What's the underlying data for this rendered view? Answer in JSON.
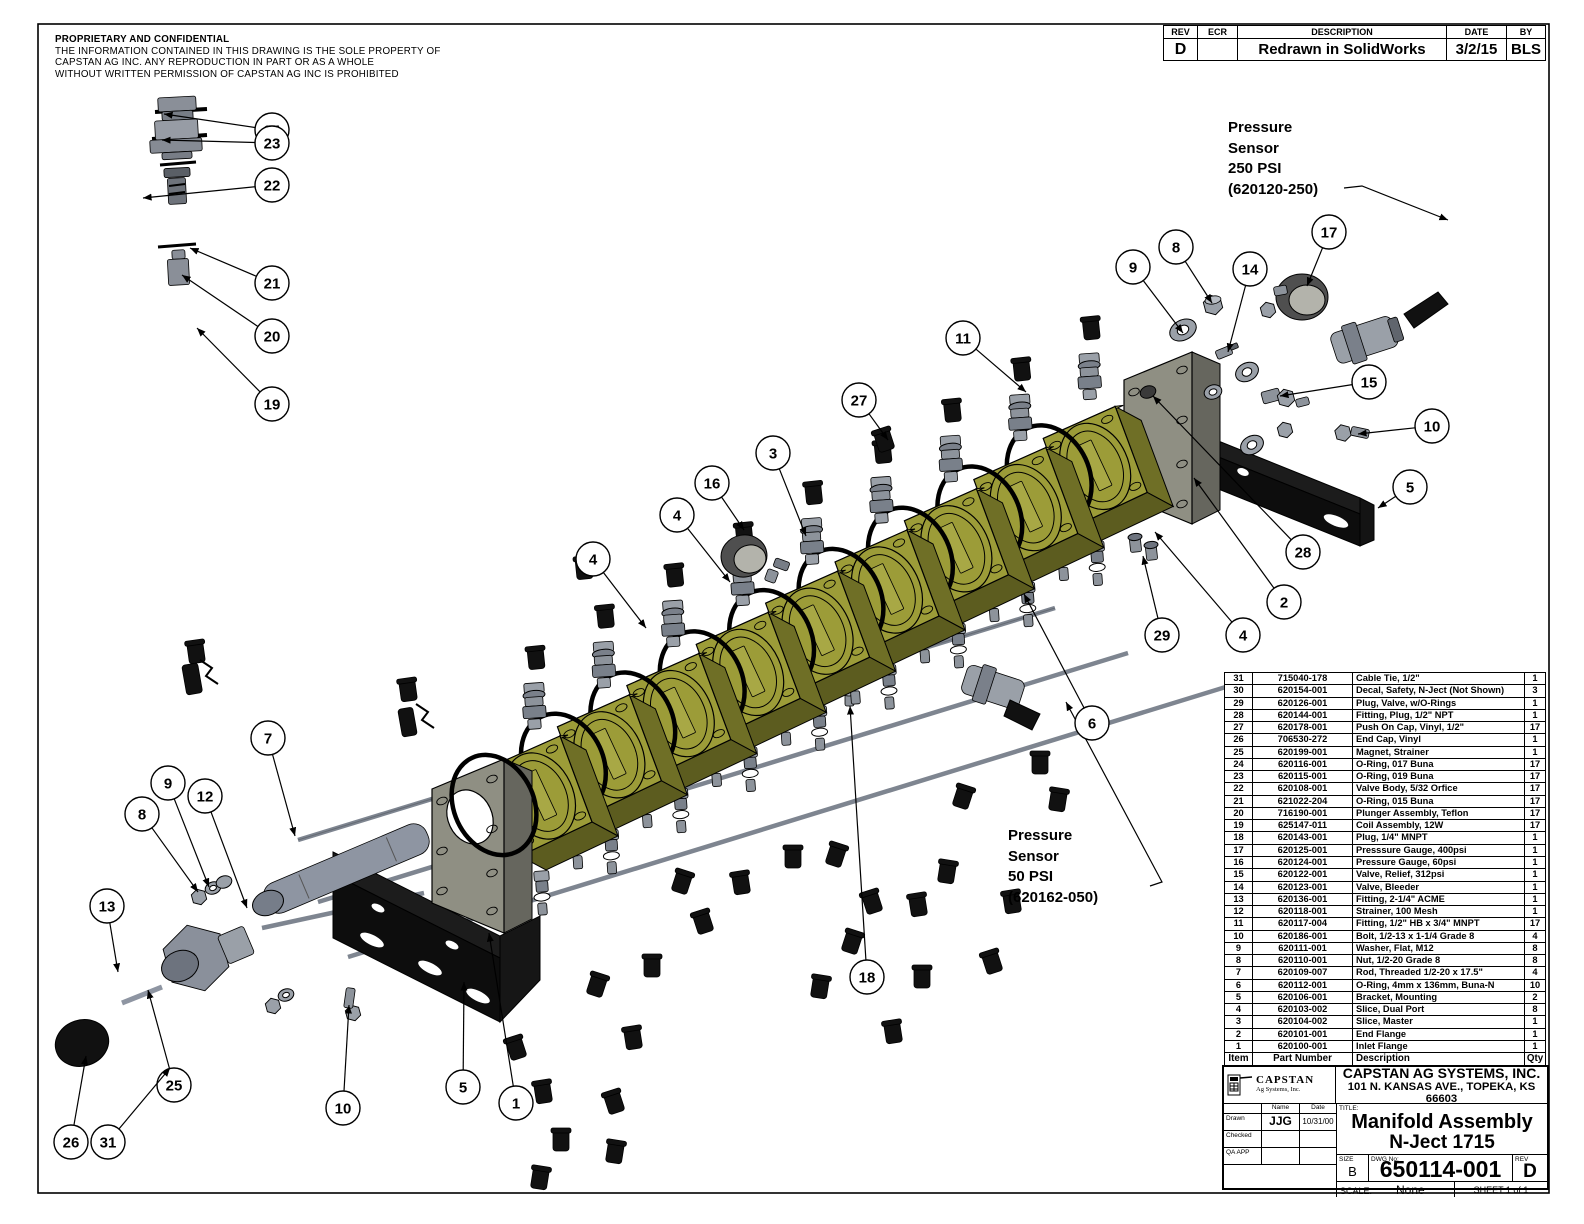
{
  "notice": {
    "title": "PROPRIETARY AND CONFIDENTIAL",
    "lines": [
      "THE INFORMATION CONTAINED IN THIS DRAWING IS THE SOLE PROPERTY OF",
      "CAPSTAN AG INC. ANY REPRODUCTION IN PART OR AS A WHOLE",
      "WITHOUT WRITTEN PERMISSION OF CAPSTAN AG INC IS PROHIBITED"
    ]
  },
  "revision_table": {
    "headers": [
      "REV",
      "ECR",
      "DESCRIPTION",
      "DATE",
      "BY"
    ],
    "row": {
      "rev": "D",
      "ecr": "",
      "description": "Redrawn in SolidWorks",
      "date": "3/2/15",
      "by": "BLS"
    }
  },
  "labels": {
    "sensor250": [
      "Pressure",
      "Sensor",
      "250 PSI",
      "(620120-250)"
    ],
    "sensor50": [
      "Pressure",
      "Sensor",
      "50 PSI",
      "(620162-050)"
    ]
  },
  "parts_table": {
    "headers": [
      "Item",
      "Part Number",
      "Description",
      "Qty"
    ],
    "rows": [
      {
        "item": 31,
        "pn": "715040-178",
        "desc": "Cable Tie, 1/2\"",
        "qty": 1
      },
      {
        "item": 30,
        "pn": "620154-001",
        "desc": "Decal, Safety, N-Ject (Not Shown)",
        "qty": 3
      },
      {
        "item": 29,
        "pn": "620126-001",
        "desc": "Plug, Valve, w/O-Rings",
        "qty": 1
      },
      {
        "item": 28,
        "pn": "620144-001",
        "desc": "Fitting, Plug, 1/2\" NPT",
        "qty": 1
      },
      {
        "item": 27,
        "pn": "620178-001",
        "desc": "Push On Cap, Vinyl, 1/2\"",
        "qty": 17
      },
      {
        "item": 26,
        "pn": "706530-272",
        "desc": "End Cap, Vinyl",
        "qty": 1
      },
      {
        "item": 25,
        "pn": "620199-001",
        "desc": "Magnet, Strainer",
        "qty": 1
      },
      {
        "item": 24,
        "pn": "620116-001",
        "desc": "O-Ring, 017 Buna",
        "qty": 17
      },
      {
        "item": 23,
        "pn": "620115-001",
        "desc": "O-Ring, 019 Buna",
        "qty": 17
      },
      {
        "item": 22,
        "pn": "620108-001",
        "desc": "Valve Body, 5/32 Orfice",
        "qty": 17
      },
      {
        "item": 21,
        "pn": "621022-204",
        "desc": "O-Ring, 015 Buna",
        "qty": 17
      },
      {
        "item": 20,
        "pn": "716190-001",
        "desc": "Plunger Assembly, Teflon",
        "qty": 17
      },
      {
        "item": 19,
        "pn": "625147-011",
        "desc": "Coil Assembly, 12W",
        "qty": 17
      },
      {
        "item": 18,
        "pn": "620143-001",
        "desc": "Plug, 1/4\" MNPT",
        "qty": 1
      },
      {
        "item": 17,
        "pn": "620125-001",
        "desc": "Presssure Gauge, 400psi",
        "qty": 1
      },
      {
        "item": 16,
        "pn": "620124-001",
        "desc": "Pressure Gauge, 60psi",
        "qty": 1
      },
      {
        "item": 15,
        "pn": "620122-001",
        "desc": "Valve, Relief, 312psi",
        "qty": 1
      },
      {
        "item": 14,
        "pn": "620123-001",
        "desc": "Valve, Bleeder",
        "qty": 1
      },
      {
        "item": 13,
        "pn": "620136-001",
        "desc": "Fitting, 2-1/4\" ACME",
        "qty": 1
      },
      {
        "item": 12,
        "pn": "620118-001",
        "desc": "Strainer, 100 Mesh",
        "qty": 1
      },
      {
        "item": 11,
        "pn": "620117-004",
        "desc": "Fitting, 1/2\" HB x 3/4\" MNPT",
        "qty": 17
      },
      {
        "item": 10,
        "pn": "620186-001",
        "desc": "Bolt, 1/2-13 x 1-1/4 Grade 8",
        "qty": 4
      },
      {
        "item": 9,
        "pn": "620111-001",
        "desc": "Washer, Flat, M12",
        "qty": 8
      },
      {
        "item": 8,
        "pn": "620110-001",
        "desc": "Nut, 1/2-20 Grade 8",
        "qty": 8
      },
      {
        "item": 7,
        "pn": "620109-007",
        "desc": "Rod, Threaded 1/2-20 x 17.5\"",
        "qty": 4
      },
      {
        "item": 6,
        "pn": "620112-001",
        "desc": "O-Ring, 4mm x 136mm, Buna-N",
        "qty": 10
      },
      {
        "item": 5,
        "pn": "620106-001",
        "desc": "Bracket, Mounting",
        "qty": 2
      },
      {
        "item": 4,
        "pn": "620103-002",
        "desc": "Slice, Dual Port",
        "qty": 8
      },
      {
        "item": 3,
        "pn": "620104-002",
        "desc": "Slice, Master",
        "qty": 1
      },
      {
        "item": 2,
        "pn": "620101-001",
        "desc": "End Flange",
        "qty": 1
      },
      {
        "item": 1,
        "pn": "620100-001",
        "desc": "Inlet Flange",
        "qty": 1
      }
    ]
  },
  "title_block": {
    "logo_line1": "CAPSTAN",
    "logo_line2": "Ag Systems, Inc.",
    "company": "CAPSTAN AG SYSTEMS, INC.",
    "address": "101 N. KANSAS AVE., TOPEKA, KS 66603",
    "name_header": "Name",
    "date_header": "Date",
    "drawn_label": "Drawn",
    "drawn_name": "JJG",
    "drawn_date": "10/31/00",
    "checked_label": "Checked",
    "qa_label": "QA APP",
    "title_label": "TITLE:",
    "title_line1": "Manifold Assembly",
    "title_line2": "N-Ject 1715",
    "size_label": "SIZE",
    "size": "B",
    "dwg_label": "DWG No:",
    "dwg_no": "650114-001",
    "rev_label": "REV",
    "rev": "D",
    "scale_label": "SCALE:",
    "scale": "None",
    "sheet": "SHEET 1 of 1"
  },
  "balloons": [
    [
      "24",
      272,
      130,
      164,
      114
    ],
    [
      "23",
      272,
      143,
      162,
      140
    ],
    [
      "22",
      272,
      185,
      143,
      198
    ],
    [
      "21",
      272,
      283,
      190,
      248
    ],
    [
      "20",
      272,
      336,
      182,
      275
    ],
    [
      "19",
      272,
      404,
      197,
      328
    ],
    [
      "27",
      859,
      400,
      888,
      440
    ],
    [
      "3",
      773,
      453,
      806,
      536
    ],
    [
      "16",
      712,
      483,
      744,
      530
    ],
    [
      "4",
      677,
      515,
      730,
      582
    ],
    [
      "4",
      593,
      559,
      646,
      628
    ],
    [
      "11",
      963,
      338,
      1026,
      392
    ],
    [
      "9",
      1133,
      267,
      1183,
      333
    ],
    [
      "8",
      1176,
      247,
      1212,
      303
    ],
    [
      "14",
      1250,
      269,
      1228,
      352
    ],
    [
      "17",
      1329,
      232,
      1307,
      286
    ],
    [
      "15",
      1369,
      382,
      1280,
      396
    ],
    [
      "10",
      1432,
      426,
      1358,
      434
    ],
    [
      "5",
      1410,
      487,
      1378,
      508
    ],
    [
      "28",
      1303,
      552,
      1153,
      396
    ],
    [
      "2",
      1284,
      602,
      1194,
      478
    ],
    [
      "4",
      1243,
      635,
      1155,
      532
    ],
    [
      "29",
      1162,
      635,
      1143,
      556
    ],
    [
      "6",
      1092,
      723,
      1024,
      594
    ],
    [
      "18",
      867,
      977,
      850,
      706
    ],
    [
      "7",
      268,
      738,
      295,
      836
    ],
    [
      "9",
      168,
      783,
      209,
      887
    ],
    [
      "12",
      205,
      796,
      247,
      908
    ],
    [
      "8",
      142,
      814,
      198,
      892
    ],
    [
      "13",
      107,
      906,
      118,
      972
    ],
    [
      "25",
      174,
      1085,
      148,
      990
    ],
    [
      "10",
      343,
      1108,
      349,
      1005
    ],
    [
      "5",
      463,
      1087,
      464,
      982
    ],
    [
      "1",
      516,
      1103,
      489,
      933
    ],
    [
      "26",
      71,
      1142,
      86,
      1056
    ],
    [
      "31",
      108,
      1142,
      170,
      1068
    ]
  ],
  "colors": {
    "olive_face": "#9c9c38",
    "olive_top": "#b3b356",
    "olive_side": "#6f6f26",
    "plate_face": "#8f8f83",
    "plate_side": "#66665e",
    "metal": "#9aa0a8",
    "metal_dark": "#747a84",
    "black": "#111111"
  }
}
